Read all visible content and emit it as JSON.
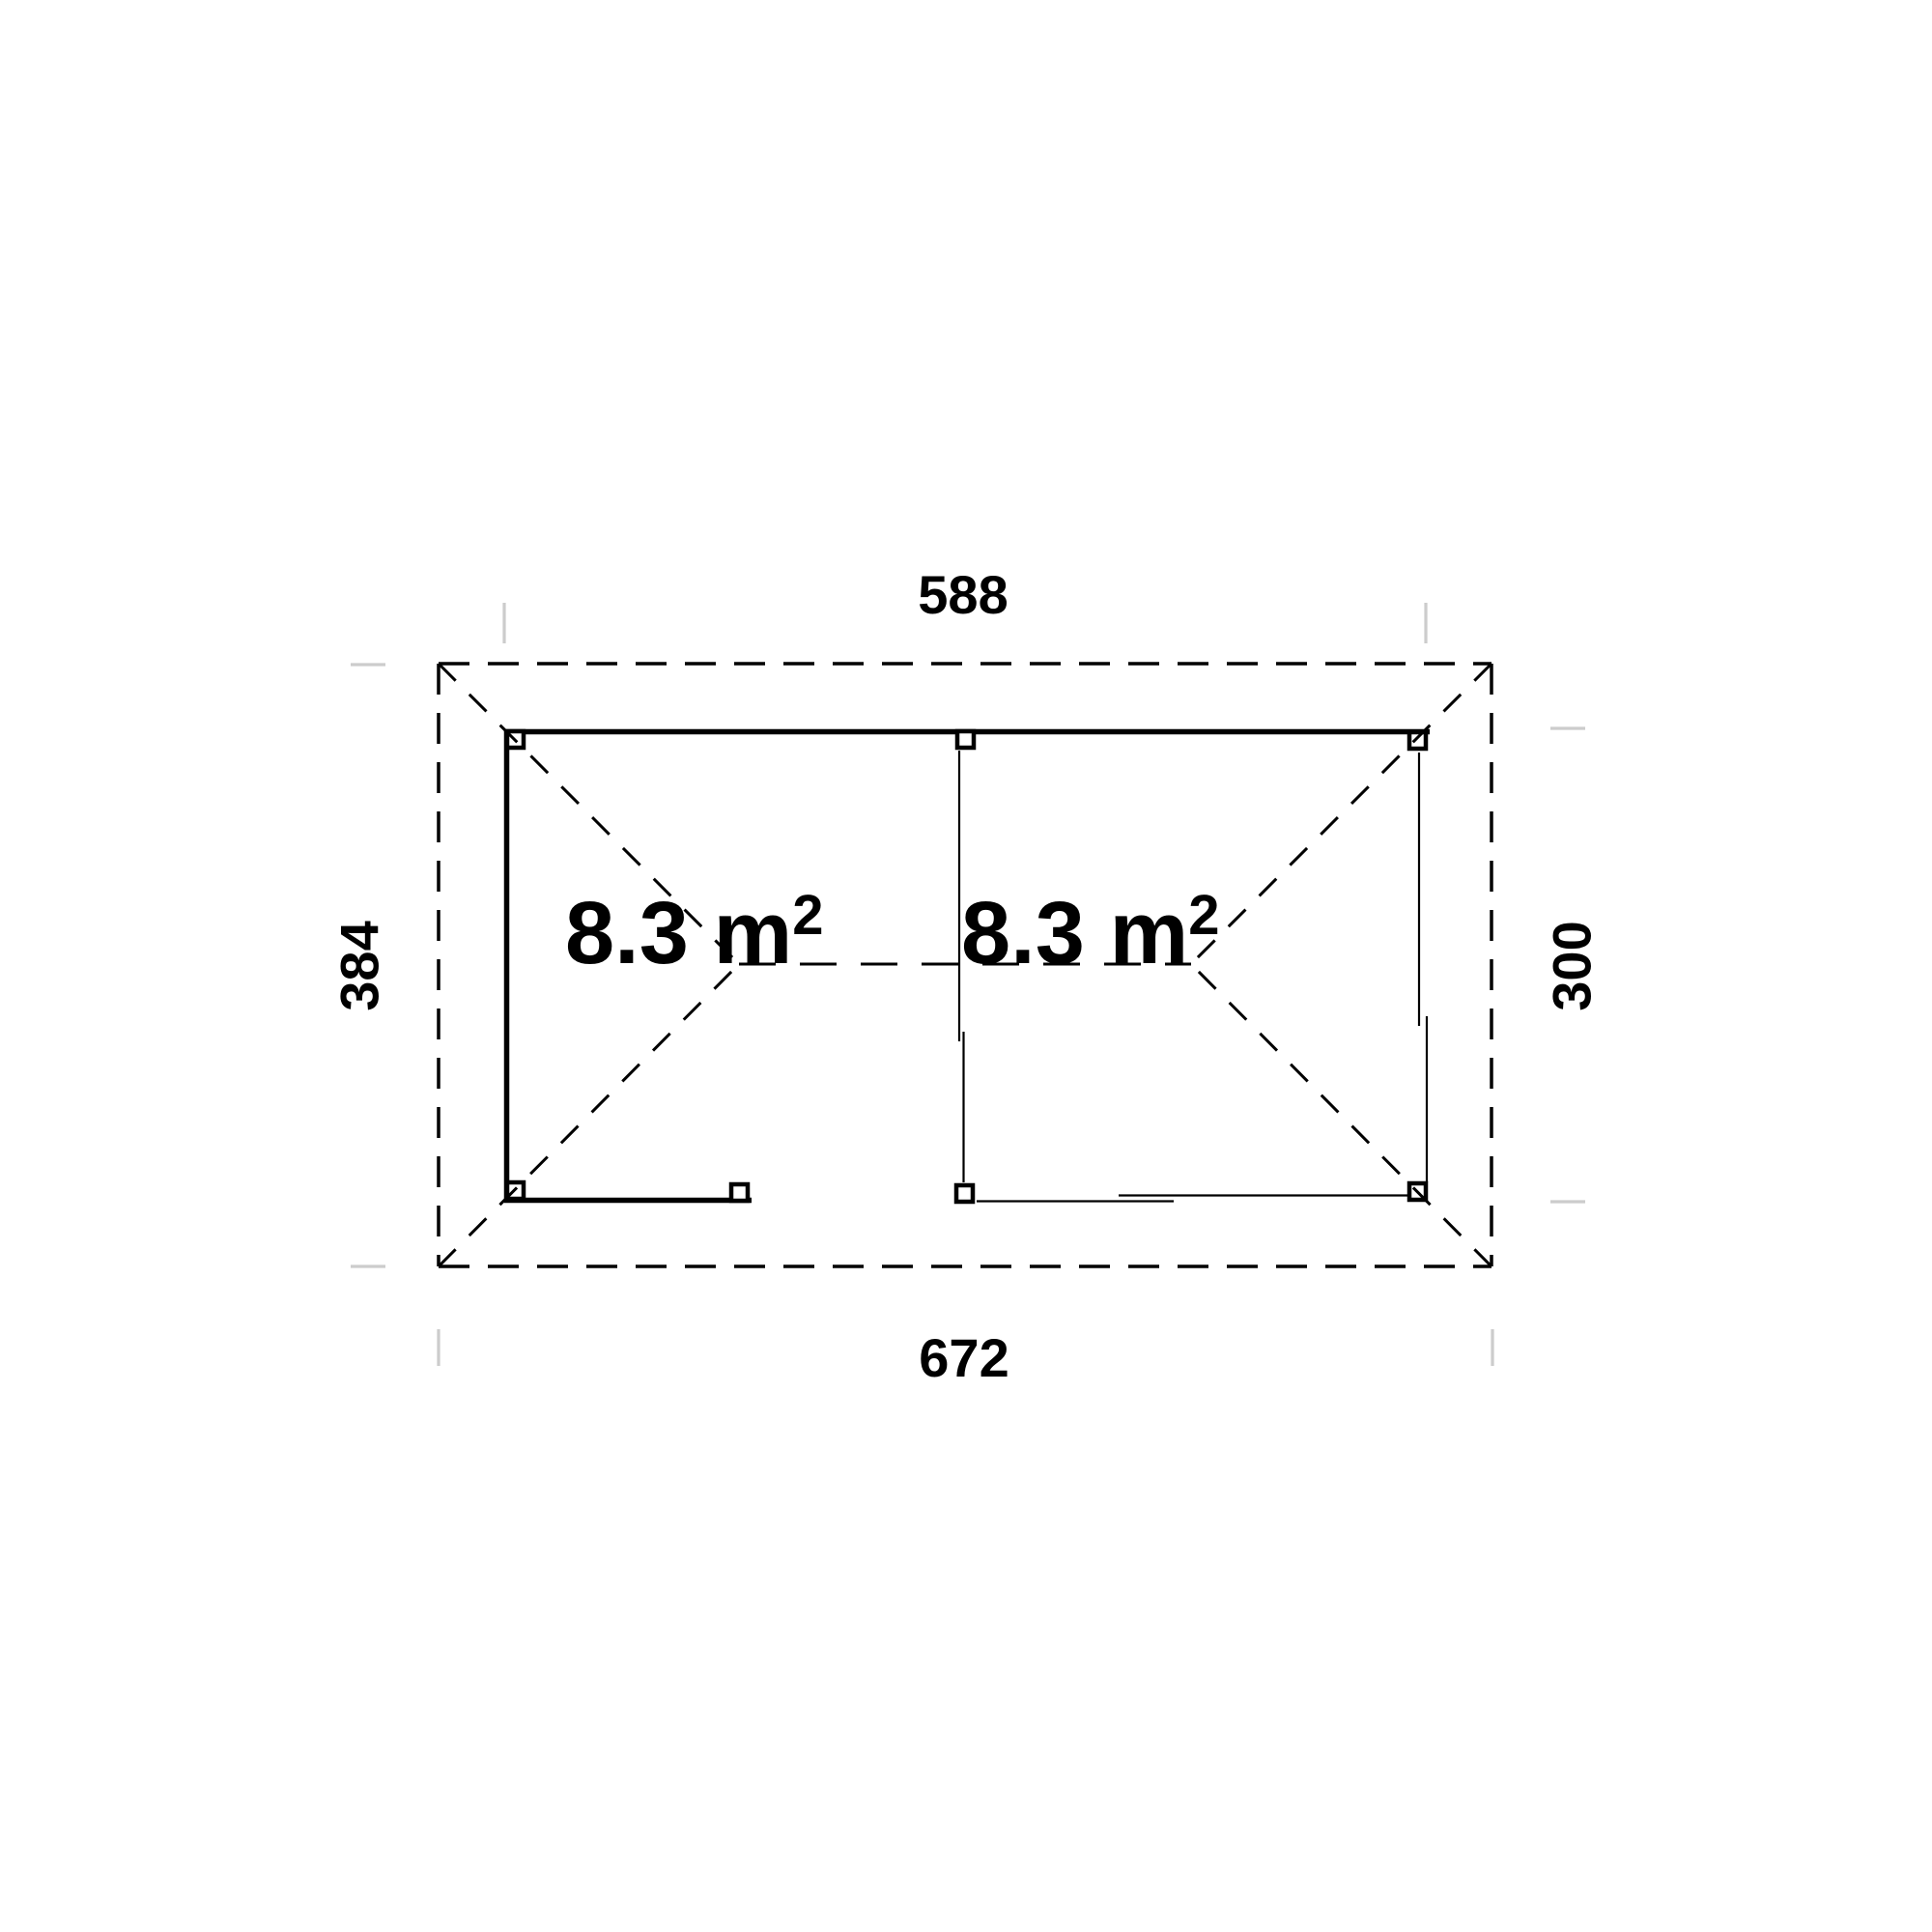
{
  "drawing": {
    "type": "floor-plan",
    "dimension_labels": {
      "top": "588",
      "bottom": "672",
      "left": "384",
      "right": "300"
    },
    "area_labels": {
      "left_room": {
        "value": "8.3 m",
        "sup": "2"
      },
      "right_room": {
        "value": "8.3 m",
        "sup": "2"
      }
    },
    "colors": {
      "background": "#ffffff",
      "line": "#000000",
      "tick": "#cccccc",
      "text": "#000000"
    }
  }
}
